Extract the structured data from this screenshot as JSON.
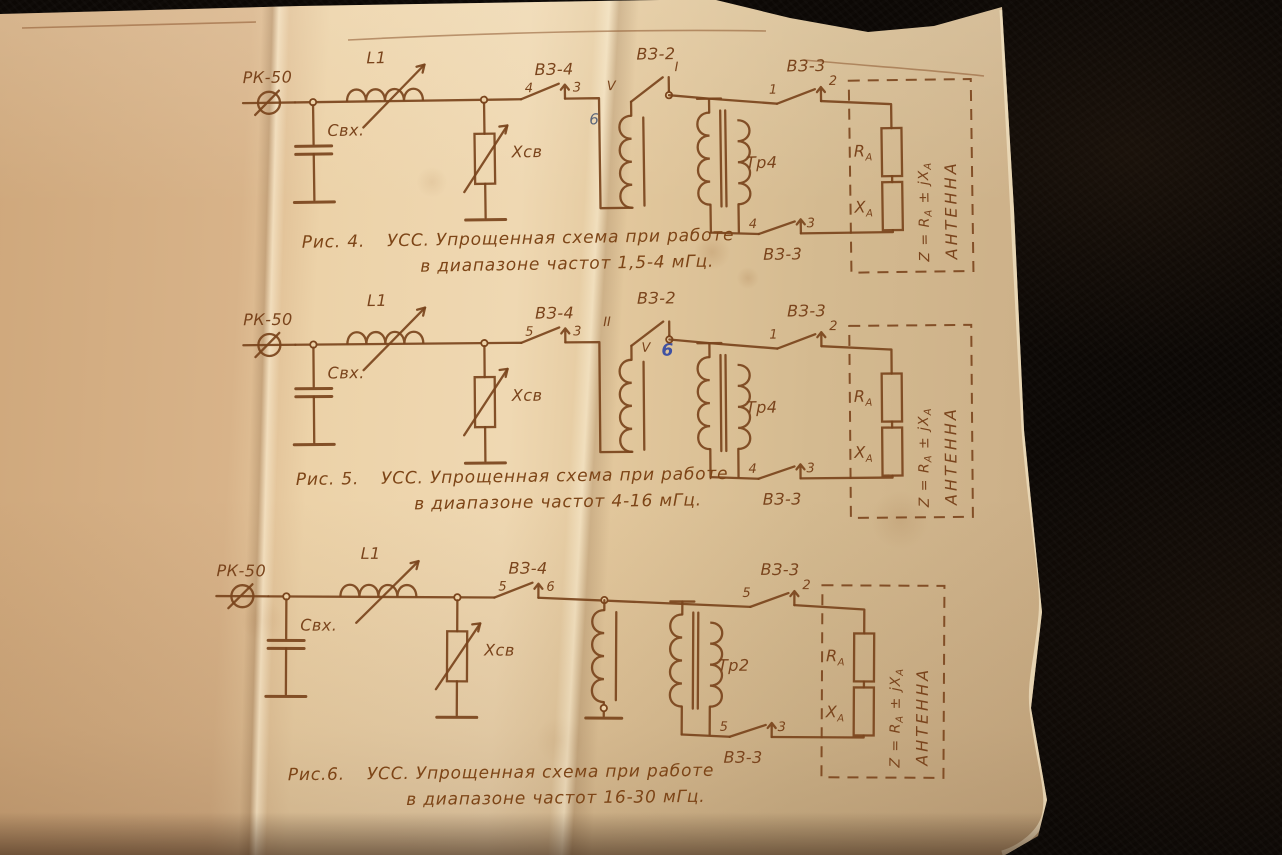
{
  "scene": {
    "background_color": "#0c0805",
    "paper_color": "#e3c79c",
    "ink_color": "#7a441c",
    "pencil_note_color_fig4": "#5d6678",
    "pencil_note_color_fig5": "#3f51a2"
  },
  "figures": [
    {
      "number": "Рис. 4.",
      "caption_line1": "УСС. Упрощенная схема при работе",
      "caption_line2": "в диапазоне частот 1,5-4 мГц.",
      "connector": "РК-50",
      "input_capacitor": "Свх.",
      "inductor": "L1",
      "coupling_reactance": "Хсв",
      "switch_vz4": {
        "label": "ВЗ-4",
        "from_contact": "4",
        "to_contact": "3"
      },
      "switch_vz2": {
        "label": "ВЗ-2",
        "from_contact": "V",
        "to_contact": "I",
        "pencil_note": "6"
      },
      "transformer": "Тр4",
      "switch_vz3_top": {
        "label": "ВЗ-3",
        "from_contact": "1",
        "to_contact": "2"
      },
      "switch_vz3_bottom": {
        "label": "ВЗ-3",
        "from_contact": "4",
        "to_contact": "3"
      },
      "antenna": {
        "resistance_main": "R",
        "resistance_sub": "А",
        "reactance_main": "Х",
        "reactance_sub": "А",
        "impedance_parts": [
          "Z = R",
          "А",
          " ± jХ",
          "А"
        ],
        "label": "АНТЕННА"
      }
    },
    {
      "number": "Рис. 5.",
      "caption_line1": "УСС. Упрощенная схема при работе",
      "caption_line2": "в диапазоне частот 4-16 мГц.",
      "connector": "РК-50",
      "input_capacitor": "Свх.",
      "inductor": "L1",
      "coupling_reactance": "Хсв",
      "switch_vz4": {
        "label": "ВЗ-4",
        "from_contact": "5",
        "to_contact": "3"
      },
      "switch_vz2": {
        "label": "ВЗ-2",
        "from_contact": "II",
        "to_contact": "V",
        "pencil_note": "6"
      },
      "transformer": "Тр4",
      "switch_vz3_top": {
        "label": "ВЗ-3",
        "from_contact": "1",
        "to_contact": "2"
      },
      "switch_vz3_bottom": {
        "label": "ВЗ-3",
        "from_contact": "4",
        "to_contact": "3"
      },
      "antenna": {
        "resistance_main": "R",
        "resistance_sub": "А",
        "reactance_main": "Х",
        "reactance_sub": "А",
        "impedance_parts": [
          "Z = R",
          "А",
          " ± jХ",
          "А"
        ],
        "label": "АНТЕННА"
      }
    },
    {
      "number": "Рис.6.",
      "caption_line1": "УСС. Упрощенная схема при работе",
      "caption_line2": "в диапазоне частот 16-30 мГц.",
      "connector": "РК-50",
      "input_capacitor": "Свх.",
      "inductor": "L1",
      "coupling_reactance": "Хсв",
      "switch_vz4": {
        "label": "ВЗ-4",
        "from_contact": "5",
        "to_contact": "6"
      },
      "transformer": "Тр2",
      "switch_vz3_top": {
        "label": "ВЗ-3",
        "from_contact": "5",
        "to_contact": "2"
      },
      "switch_vz3_bottom": {
        "label": "ВЗ-3",
        "from_contact": "5",
        "to_contact": "3"
      },
      "antenna": {
        "resistance_main": "R",
        "resistance_sub": "А",
        "reactance_main": "Х",
        "reactance_sub": "А",
        "impedance_parts": [
          "Z = R",
          "А",
          " ± jХ",
          "А"
        ],
        "label": "АНТЕННА"
      }
    }
  ]
}
